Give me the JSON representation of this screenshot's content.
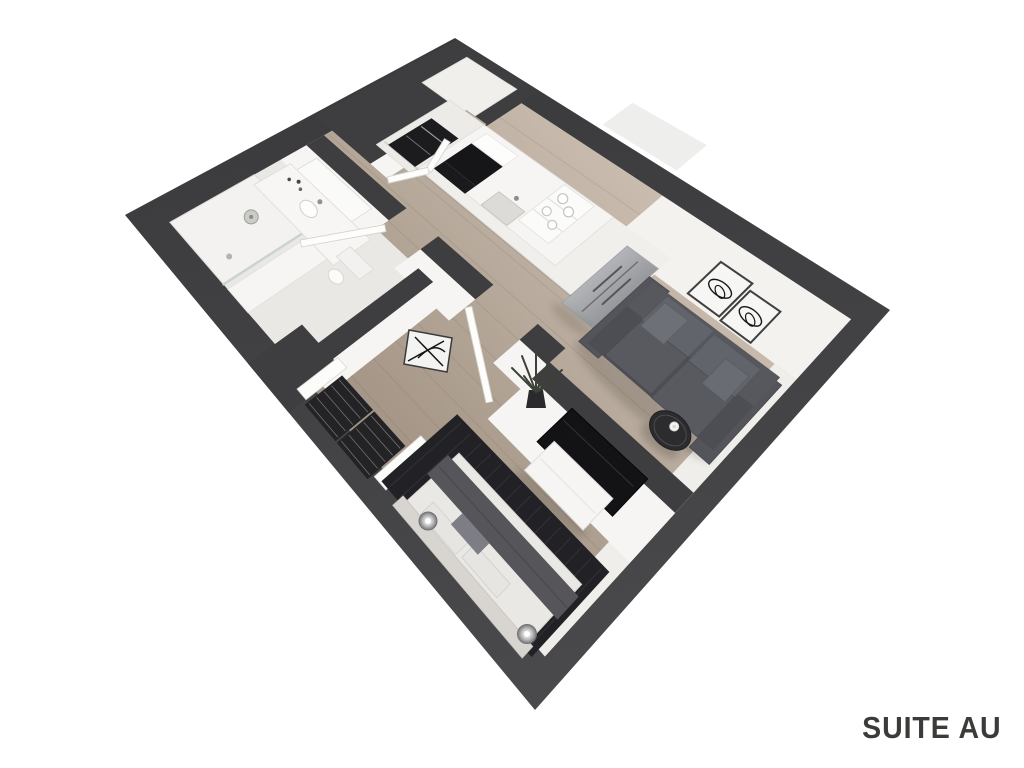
{
  "title": "SUITE AU",
  "palette": {
    "background": "#ffffff",
    "wall_dark": "#3e3e40",
    "wall_dark_deep": "#3a3a3c",
    "wall_dark_light": "#4a4a4c",
    "wall_white": "#f6f5f3",
    "wall_face": "#f3f2ef",
    "wood_light": "#cabdaf",
    "wood_mid": "#b5a797",
    "wood_dark": "#a09182",
    "tile": "#f0efec",
    "bath_floor": "#eae8e5",
    "shower_floor": "#f3f2f0",
    "glass": "#c8d1d2",
    "sofa_base": "#4c4e53",
    "sofa_light": "#62646b",
    "rug": "#222226",
    "rug_stripe": "#35353c",
    "bed_duvet": "#eae8e4",
    "bed_headboard": "#d8d5d1",
    "throw": "#55555a",
    "pillow": "#e7e5e1",
    "pillow_accent": "#7d7d85",
    "tv": "#131315",
    "appliance_dark": "#1c1c1e",
    "art_ink": "#161616",
    "lamp": "#8e8e90",
    "plant": "#3d4238",
    "table": "#2c2c2f",
    "title_color": "#3b3b39"
  }
}
